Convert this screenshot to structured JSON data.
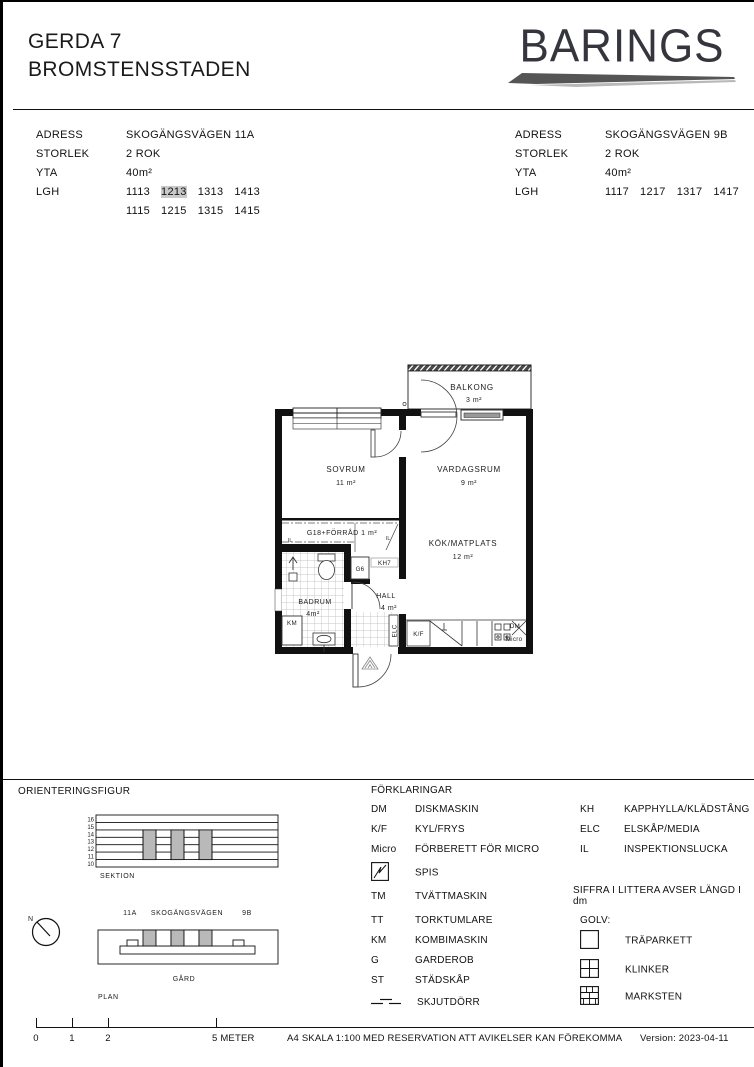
{
  "header": {
    "project": "GERDA 7",
    "subtitle": "BROMSTENSSTADEN",
    "brand": "BARINGS"
  },
  "colors": {
    "wall": "#111111",
    "section_cell_gray": "#b9b9b9",
    "lgh_highlight": "#c9c9c9",
    "brand_text": "#35353d"
  },
  "info": {
    "row_labels": [
      "ADRESS",
      "STORLEK",
      "YTA",
      "LGH"
    ],
    "left": {
      "adress": "SKOGÄNGSVÄGEN 11A",
      "storlek": "2 ROK",
      "yta": "40m²",
      "lgh1": [
        "1113",
        "1213",
        "1313",
        "1413"
      ],
      "lgh2": [
        "1115",
        "1215",
        "1315",
        "1415"
      ],
      "lgh_highlighted": "1213"
    },
    "right": {
      "adress": "SKOGÄNGSVÄGEN 9B",
      "storlek": "2 ROK",
      "yta": "40m²",
      "lgh1": [
        "1117",
        "1217",
        "1317",
        "1417"
      ]
    }
  },
  "floorplan": {
    "rooms": {
      "balkong": {
        "name": "BALKONG",
        "area": "3 m²"
      },
      "sovrum": {
        "name": "SOVRUM",
        "area": "11 m²"
      },
      "vardagsrum": {
        "name": "VARDAGSRUM",
        "area": "9 m²"
      },
      "kok": {
        "name": "KÖK/MATPLATS",
        "area": "12 m²"
      },
      "forrad": {
        "name": "G18+FÖRRÅD 1 m²"
      },
      "badrum": {
        "name": "BADRUM",
        "area": "4m²"
      },
      "hall": {
        "name": "HALL",
        "area": "4 m²"
      }
    },
    "fixtures": {
      "km": "KM",
      "kf": "K/F",
      "dm": "DM",
      "micro": "Micro",
      "g6": "G6",
      "kh7": "KH7",
      "elc": "ELC",
      "il": "IL"
    }
  },
  "orientering": {
    "title": "ORIENTERINGSFIGUR",
    "sektion": "SEKTION",
    "plan": "PLAN",
    "gard": "GÅRD",
    "north": "N",
    "street": "SKOGÄNGSVÄGEN",
    "left_no": "11A",
    "right_no": "9B",
    "floors": [
      "16",
      "15",
      "14",
      "13",
      "12",
      "11",
      "10"
    ]
  },
  "legend": {
    "title": "FÖRKLARINGAR",
    "left": [
      {
        "code": "DM",
        "desc": "DISKMASKIN"
      },
      {
        "code": "K/F",
        "desc": "KYL/FRYS"
      },
      {
        "code": "Micro",
        "desc": "FÖRBERETT FÖR MICRO"
      },
      {
        "code": "",
        "desc": "SPIS"
      },
      {
        "code": "TM",
        "desc": "TVÄTTMASKIN"
      },
      {
        "code": "TT",
        "desc": "TORKTUMLARE"
      },
      {
        "code": "KM",
        "desc": "KOMBIMASKIN"
      },
      {
        "code": "G",
        "desc": "GARDEROB"
      },
      {
        "code": "ST",
        "desc": "STÄDSKÅP"
      },
      {
        "code": "",
        "desc": "SKJUTDÖRR"
      }
    ],
    "right": [
      {
        "code": "KH",
        "desc": "KAPPHYLLA/KLÄDSTÅNG"
      },
      {
        "code": "ELC",
        "desc": "ELSKÅP/MEDIA"
      },
      {
        "code": "IL",
        "desc": "INSPEKTIONSLUCKA"
      }
    ],
    "note": "SIFFRA I LITTERA AVSER LÄNGD I dm",
    "golv_title": "GOLV:",
    "golv": [
      {
        "desc": "TRÄPARKETT"
      },
      {
        "desc": "KLINKER"
      },
      {
        "desc": "MARKSTEN"
      }
    ]
  },
  "footer": {
    "ticks": [
      "0",
      "1",
      "2",
      "5 METER"
    ],
    "skala": "A4 SKALA 1:100",
    "disclaimer": "MED RESERVATION ATT AVIKELSER KAN FÖREKOMMA",
    "version": "Version: 2023-04-11"
  }
}
